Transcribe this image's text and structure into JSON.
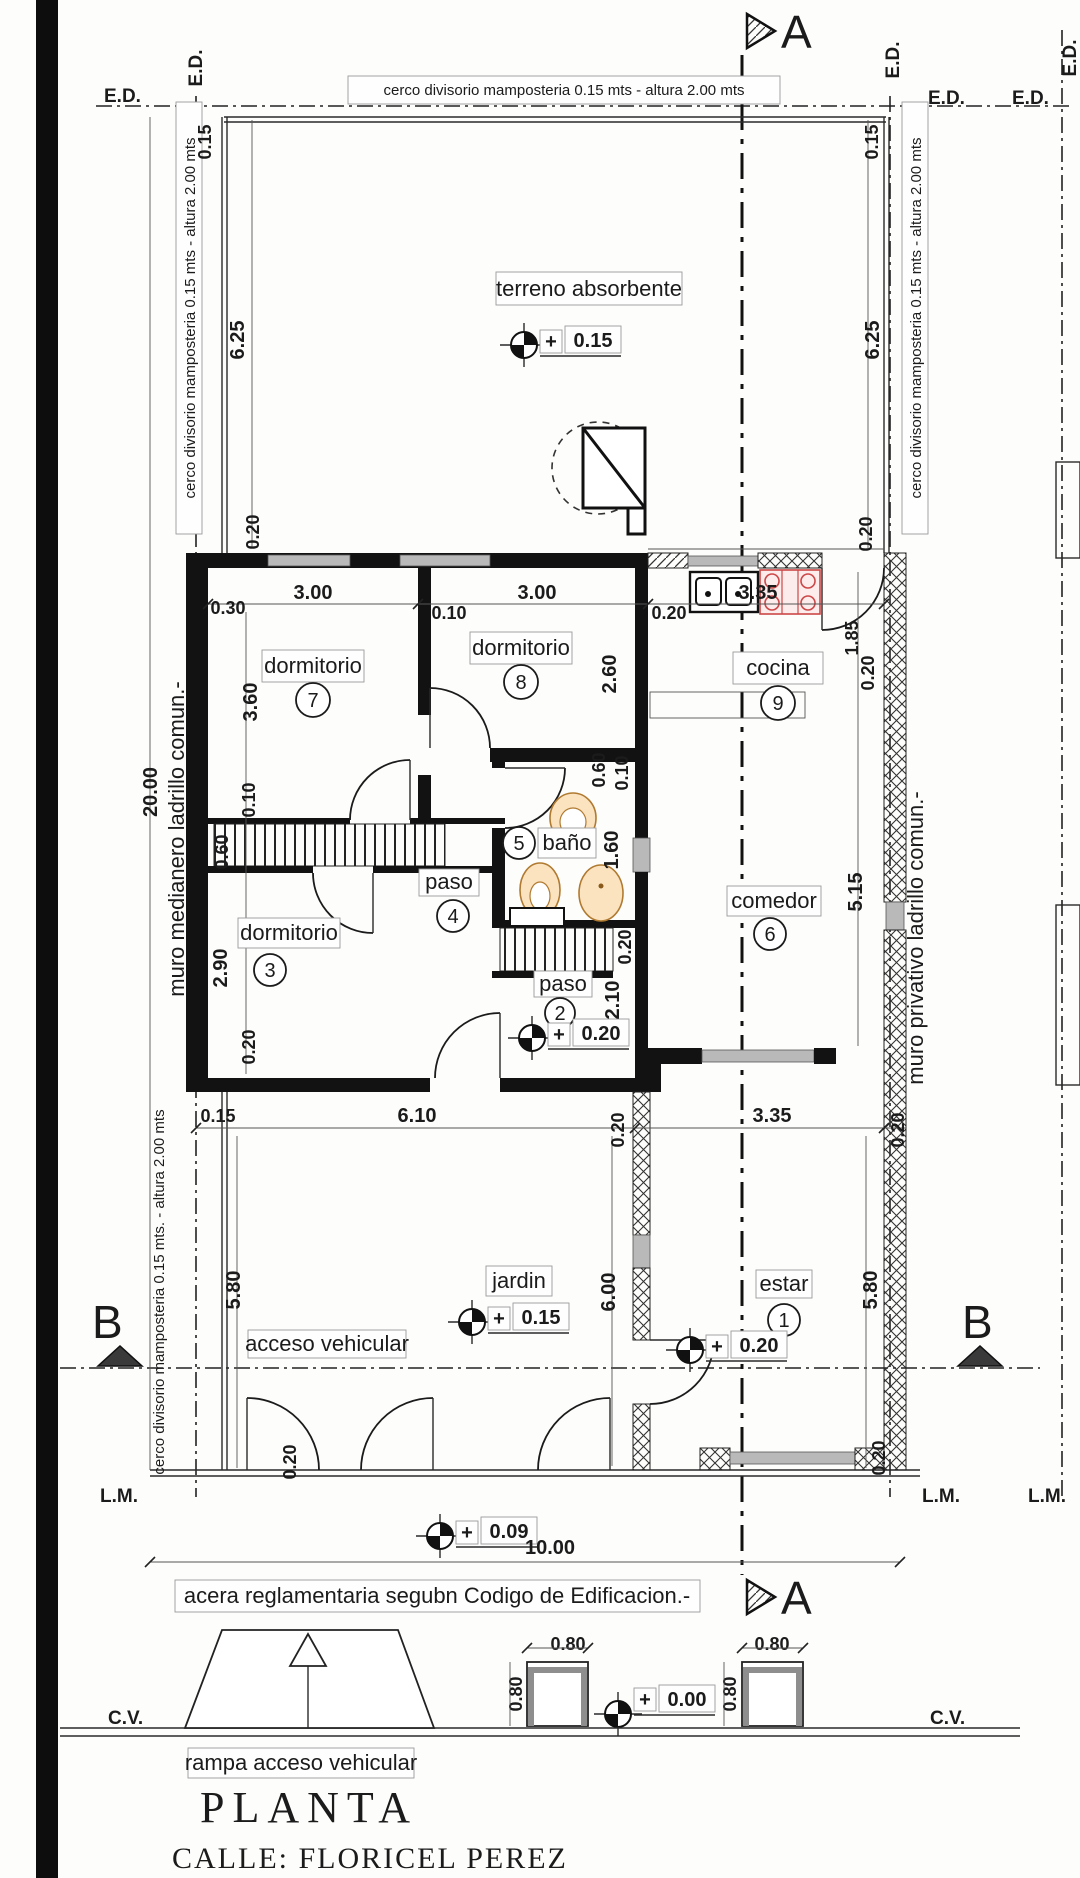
{
  "title": {
    "plan": "PLANTA",
    "street": "CALLE:   FLORICEL PEREZ"
  },
  "sections": {
    "a": "A",
    "b": "B"
  },
  "boundary": {
    "ed": "E.D.",
    "lm": "L.M.",
    "cv": "C.V."
  },
  "notes": {
    "fence_top": "cerco divisorio mamposteria 0.15 mts - altura 2.00 mts",
    "fence_left": "cerco divisorio mamposteria 0.15 mts - altura 2.00 mts",
    "fence_right": "cerco divisorio mamposteria 0.15 mts - altura 2.00 mts",
    "fence_left_bottom": "cerco divisorio mamposteria 0.15 mts. - altura 2.00 mts",
    "muro_medianero": "muro medianero ladrillo comun.-",
    "muro_privativo": "muro privativo ladrillo comun.-",
    "terreno": "terreno absorbente",
    "acceso": "acceso vehicular",
    "acera": "acera reglamentaria segubn Codigo de Edificacion.-",
    "rampa": "rampa acceso vehicular"
  },
  "rooms": {
    "dorm7": {
      "label": "dormitorio",
      "number": "7"
    },
    "dorm8": {
      "label": "dormitorio",
      "number": "8"
    },
    "cocina": {
      "label": "cocina",
      "number": "9"
    },
    "banio": {
      "label": "baño",
      "number": "5"
    },
    "paso4": {
      "label": "paso",
      "number": "4"
    },
    "dorm3": {
      "label": "dormitorio",
      "number": "3"
    },
    "paso2": {
      "label": "paso",
      "number": "2"
    },
    "comedor": {
      "label": "comedor",
      "number": "6"
    },
    "estar": {
      "label": "estar",
      "number": "1"
    },
    "jardin": {
      "label": "jardin"
    }
  },
  "levels": {
    "plus": "+",
    "terreno": "0.15",
    "jardin": "0.15",
    "estar": "0.20",
    "paso": "0.20",
    "acera": "0.09",
    "calle": "0.00"
  },
  "dims": {
    "d010": "0.10",
    "d015": "0.15",
    "d020": "0.20",
    "d030": "0.30",
    "d060": "0.60",
    "d080": "0.80",
    "d160": "1.60",
    "d185": "1.85",
    "d210": "2.10",
    "d260": "2.60",
    "d290": "2.90",
    "d300": "3.00",
    "d335": "3.35",
    "d360": "3.60",
    "d515": "5.15",
    "d580": "5.80",
    "d600": "6.00",
    "d610": "6.10",
    "d625": "6.25",
    "d1000": "10.00",
    "d2000": "20.00"
  },
  "colors": {
    "wall": "#121212",
    "window": "#b9b9b9",
    "fixture_orange": "#fbe3c0",
    "stove_red": "#cc4747",
    "paper": "#fdfdfc"
  }
}
